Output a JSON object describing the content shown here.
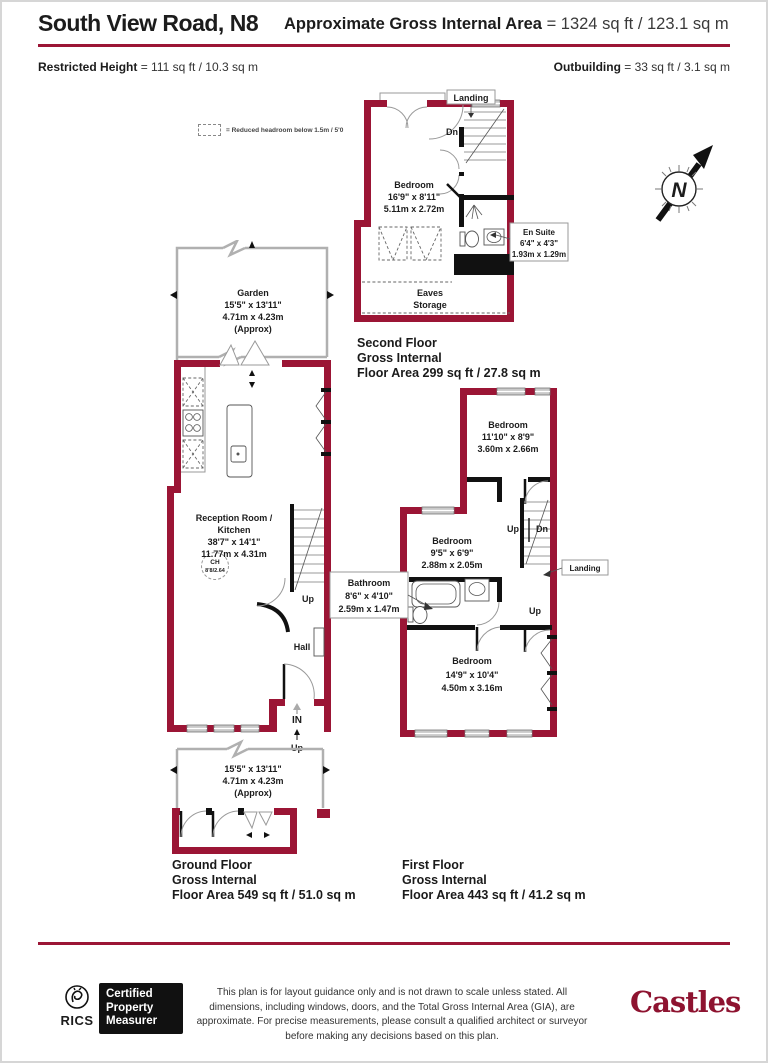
{
  "header": {
    "title": "South View Road, N8",
    "gia_label": "Approximate Gross Internal Area",
    "gia_value": "= 1324 sq ft / 123.1 sq m",
    "restricted_label": "Restricted Height",
    "restricted_value": "= 111 sq ft / 10.3 sq m",
    "outbuilding_label": "Outbuilding",
    "outbuilding_value": "= 33 sq ft / 3.1 sq m"
  },
  "legend": {
    "text": "= Reduced headroom below 1.5m / 5'0"
  },
  "compass": {
    "north": "N"
  },
  "second_floor": {
    "landing": "Landing",
    "dn": "Dn",
    "bedroom_name": "Bedroom",
    "bedroom_imperial": "16'9\" x 8'11\"",
    "bedroom_metric": "5.11m x 2.72m",
    "ensuite_name": "En Suite",
    "ensuite_imperial": "6'4\" x 4'3\"",
    "ensuite_metric": "1.93m x 1.29m",
    "eaves1": "Eaves",
    "eaves2": "Storage",
    "floor_name": "Second Floor",
    "gross": "Gross Internal",
    "area": "Floor Area 299 sq ft / 27.8 sq m"
  },
  "ground_floor": {
    "garden_name": "Garden",
    "garden_imperial": "15'5\" x 13'11\"",
    "garden_metric": "4.71m x 4.23m",
    "garden_approx": "(Approx)",
    "reception1": "Reception Room /",
    "reception2": "Kitchen",
    "reception_imperial": "38'7\" x 14'1\"",
    "reception_metric": "11.77m x 4.31m",
    "ch1": "CH",
    "ch2": "8'8/2.64",
    "up": "Up",
    "hall": "Hall",
    "in": "IN",
    "entry_up": "Up",
    "front_imperial": "15'5\" x 13'11\"",
    "front_metric": "4.71m x 4.23m",
    "front_approx": "(Approx)",
    "floor_name": "Ground Floor",
    "gross": "Gross Internal",
    "area": "Floor Area 549 sq ft / 51.0 sq m"
  },
  "first_floor": {
    "bed_rear_name": "Bedroom",
    "bed_rear_imperial": "11'10\" x 8'9\"",
    "bed_rear_metric": "3.60m x 2.66m",
    "bed_mid_name": "Bedroom",
    "bed_mid_imperial": "9'5\" x 6'9\"",
    "bed_mid_metric": "2.88m x 2.05m",
    "bathroom_name": "Bathroom",
    "bathroom_imperial": "8'6\" x 4'10\"",
    "bathroom_metric": "2.59m x 1.47m",
    "bed_front_name": "Bedroom",
    "bed_front_imperial": "14'9\" x 10'4\"",
    "bed_front_metric": "4.50m x 3.16m",
    "landing": "Landing",
    "up": "Up",
    "dn": "Dn",
    "up2": "Up",
    "floor_name": "First Floor",
    "gross": "Gross Internal",
    "area": "Floor Area 443 sq ft / 41.2 sq m"
  },
  "footer": {
    "rics": "RICS",
    "cpm1": "Certified",
    "cpm2": "Property",
    "cpm3": "Measurer",
    "disclaimer": "This plan is for layout guidance only and is not drawn to scale unless stated. All dimensions, including windows, doors, and the Total Gross Internal Area (GIA), are approximate. For precise measurements, please consult a qualified architect or surveyor before making any decisions based on this plan.",
    "brand": "Castles"
  },
  "colors": {
    "wall": "#9b1535",
    "accent_rule": "#9b1535",
    "window_fill": "#c9c9c9",
    "partition": "#111111",
    "brand_red": "#8e1330"
  }
}
